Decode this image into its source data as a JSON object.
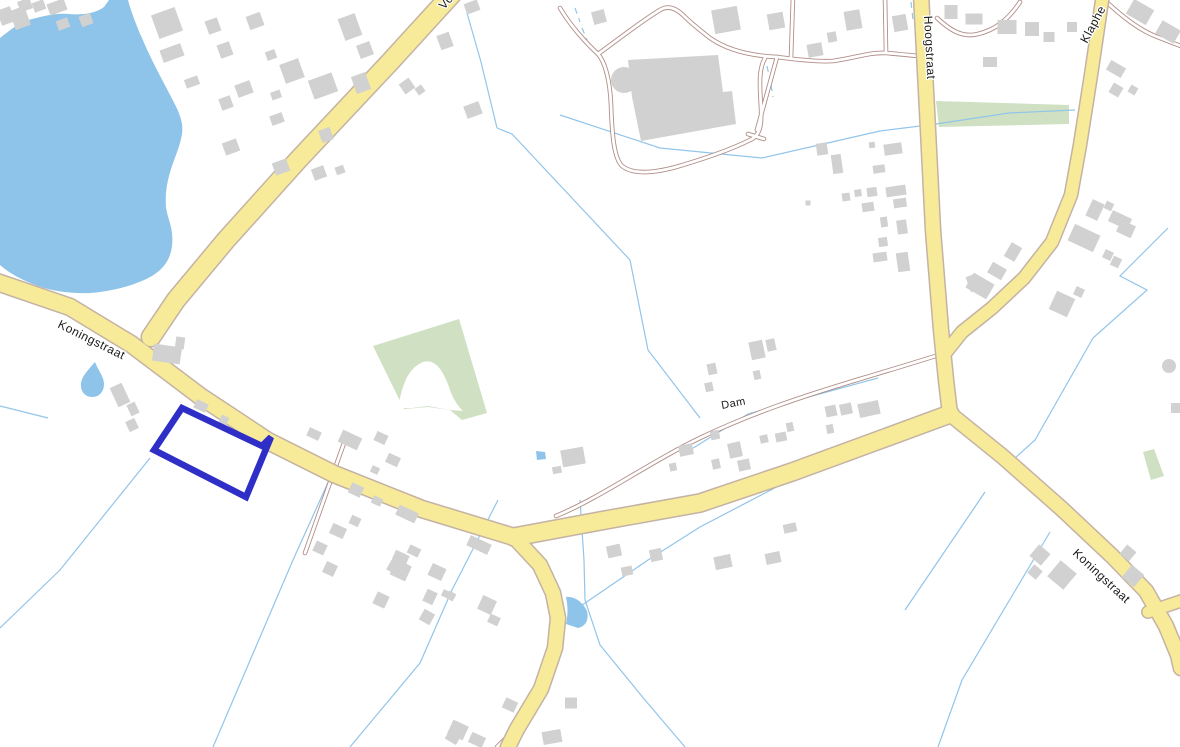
{
  "map": {
    "title": "Topographic cadastral map with selected parcel",
    "colors": {
      "background": "#ffffff",
      "water": "#8ec4e9",
      "green": "#cfe0c3",
      "boundary_line": "#92c5ea",
      "road_fill": "#f7ea99",
      "road_casing": "#c4b3a4",
      "minor_casing": "#b18e88",
      "minor_fill": "#ffffff",
      "building": "#d1d1d1",
      "parcel_highlight": "#2f2fc7",
      "label_text": "#1a1a1a"
    },
    "labels": [
      {
        "text": "Vo",
        "x": 444,
        "y": 10,
        "rotate": -48,
        "size": 12
      },
      {
        "text": "Koningstraat",
        "x": 57,
        "y": 327,
        "rotate": 26.5,
        "size": 12
      },
      {
        "text": "Hoogstraat",
        "x": 924,
        "y": 16,
        "rotate": 87,
        "size": 12
      },
      {
        "text": "Klaphe",
        "x": 1087,
        "y": 44,
        "rotate": -62,
        "size": 12
      },
      {
        "text": "Dam",
        "x": 722,
        "y": 409,
        "rotate": -11,
        "size": 11
      },
      {
        "text": "Koningstraat",
        "x": 1072,
        "y": 554,
        "rotate": 43,
        "size": 12
      }
    ],
    "water": {
      "lake": "M 0,38 C 10,30 20,22 32,19 C 45,16 55,13 68,14 C 80,15 95,14 104,7 L 109,0 L 128,0 C 130,8 136,25 142,38 C 150,57 158,72 167,89 C 174,103 180,112 182,124 C 184,136 177,152 172,166 C 167,181 165,193 166,207 C 168,221 174,228 172,246 C 170,261 163,269 152,276 C 138,284 120,289 100,292 C 80,295 55,292 38,286 C 24,281 10,274 0,265 Z",
      "ponds": [
        "M 95,362 C 99,372 104,377 104,384 C 104,392 99,397 92,397 C 85,397 80,391 81,383 C 82,376 88,370 95,362 Z",
        "M 566,597 C 574,596 583,602 587,611 C 589,620 586,626 578,628 L 566,624 C 568,615 568,606 566,597 Z",
        "M 536,451 l 9,1 1,7 -9,1 Z"
      ]
    },
    "green_areas": [
      "M 936,101 L 1069,105 L 1069,124 L 939,127 Z",
      "M 373,346 L 459,319 L 487,413 L 462,420 L 450,410 L 428,407 L 404,409 Z",
      "M 1143,452 L 1154,449 L 1164,476 L 1151,480 Z"
    ],
    "green_cutouts": [
      "M 398,408 C 402,385 408,368 423,362 C 436,358 444,372 450,390 C 453,399 458,406 463,411 L 450,410 L 428,406 L 412,408 Z"
    ],
    "boundary_lines": [
      {
        "points": "467,13 481,62 497,128"
      },
      {
        "points": "497,128 512,134 630,260"
      },
      {
        "points": "630,260 648,350 700,418"
      },
      {
        "points": "560,115 660,148 762,158 880,131 936,124"
      },
      {
        "points": "936,124 1009,113 1075,110"
      },
      {
        "points": "690,450 748,414 812,396 878,378"
      },
      {
        "points": "498,500 452,590 420,663 350,747"
      },
      {
        "points": "580,500 584,560 585,600 600,645 645,700 685,747"
      },
      {
        "points": "572,612 648,560 700,527 790,480"
      },
      {
        "points": "345,445 293,560 213,747"
      },
      {
        "points": "150,458 60,570 0,628"
      },
      {
        "points": "0,406 48,418"
      },
      {
        "points": "1093,338 1035,440 1004,468"
      },
      {
        "points": "1168,228 1120,276 1147,290 1093,338"
      },
      {
        "points": "985,492 905,610"
      },
      {
        "points": "1050,532 962,680 938,747"
      },
      {
        "points": "767,66 770,80",
        "dash": true
      },
      {
        "points": "771,85 773,97",
        "dash": true
      },
      {
        "points": "911,2 913,20",
        "dash": true
      },
      {
        "points": "575,8 580,22",
        "dash": true
      },
      {
        "points": "582,28 587,40",
        "dash": true
      }
    ],
    "major_roads": [
      {
        "d": "M 452,-6 L 390,62 L 298,160 L 226,240 L 176,300 L 151,337",
        "w": 18
      },
      {
        "d": "M -6,281 L 70,307 L 131,344 L 200,396 L 268,441 L 334,474 L 422,509 L 514,537",
        "w": 16
      },
      {
        "d": "M 514,537 L 540,565 L 553,593 L 558,618 L 555,648 L 541,689 L 517,729 L 508,747",
        "w": 14
      },
      {
        "d": "M 514,537 L 600,521 L 700,503 L 792,472 L 882,439 L 950,414",
        "w": 17
      },
      {
        "d": "M 921,-6 L 927,110 L 933,230 L 941,330 L 946,380 L 950,414",
        "w": 14
      },
      {
        "d": "M 950,414 L 1002,456 L 1062,509 L 1112,556 L 1146,591 L 1166,626 L 1178,655 L 1181,668",
        "w": 14
      },
      {
        "d": "M 1148,612 L 1181,601",
        "w": 11
      },
      {
        "d": "M 1103,-6 L 1091,75 L 1080,145 L 1071,195 L 1052,242 L 1024,278 L 992,308 L 962,332 L 946,352",
        "w": 12
      }
    ],
    "minor_roads": [
      {
        "d": "M 556,516 C 600,498 650,462 700,438 C 750,414 800,397 860,379 C 900,367 930,358 948,352"
      },
      {
        "d": "M 560,8 C 570,25 585,42 598,54 C 605,62 610,80 611,105 C 612,135 614,158 622,166 C 632,174 650,174 676,167 C 700,160 730,150 750,140 C 760,136 762,125 761,108 C 760,88 758,70 765,58"
      },
      {
        "d": "M 598,54 C 615,42 640,22 660,10 C 668,5 676,8 684,16 C 692,24 700,30 710,38 C 730,52 755,56 777,57"
      },
      {
        "d": "M 777,57 C 800,60 820,62 833,61 C 855,58 870,52 886,53 C 898,54 908,55 918,56"
      },
      {
        "d": "M 793,-4 L 791,58"
      },
      {
        "d": "M 885,-4 L 886,52"
      },
      {
        "d": "M 777,57 L 757,130"
      },
      {
        "d": "M 748,134 L 764,139"
      },
      {
        "d": "M 937,18 C 950,30 962,38 978,34 C 995,30 1008,20 1020,2"
      },
      {
        "d": "M 1100,-4 C 1115,10 1135,28 1155,36 C 1165,40 1175,44 1181,46"
      },
      {
        "d": "M 344,443 L 305,553"
      },
      {
        "d": "M 497,747 L 515,729"
      }
    ],
    "big_building": {
      "body": "M 628,60 L 718,55 L 723,92 L 732,91 L 736,124 L 641,141 L 632,97 Z",
      "tower": {
        "cx": 624,
        "cy": 80,
        "r": 13
      }
    },
    "round_building": {
      "cx": 1169,
      "cy": 366,
      "r": 7
    },
    "buildings": [
      [
        6,
        16,
        14,
        16,
        -20
      ],
      [
        20,
        18,
        16,
        20,
        -20
      ],
      [
        25,
        5,
        13,
        11,
        -20
      ],
      [
        39,
        6,
        12,
        10,
        -20
      ],
      [
        57,
        7,
        18,
        12,
        -20
      ],
      [
        63,
        24,
        12,
        10,
        -20
      ],
      [
        86,
        20,
        12,
        11,
        -20
      ],
      [
        167,
        23,
        25,
        25,
        -20
      ],
      [
        172,
        53,
        22,
        13,
        -20
      ],
      [
        213,
        26,
        13,
        14,
        -20
      ],
      [
        225,
        50,
        13,
        14,
        -20
      ],
      [
        255,
        21,
        15,
        14,
        -20
      ],
      [
        271,
        55,
        10,
        9,
        -20
      ],
      [
        192,
        82,
        14,
        9,
        -20
      ],
      [
        226,
        103,
        12,
        12,
        -20
      ],
      [
        244,
        89,
        16,
        13,
        -20
      ],
      [
        292,
        71,
        20,
        20,
        -20
      ],
      [
        323,
        86,
        25,
        20,
        -20
      ],
      [
        276,
        95,
        10,
        8,
        -20
      ],
      [
        277,
        119,
        13,
        10,
        -20
      ],
      [
        326,
        135,
        12,
        13,
        -20
      ],
      [
        350,
        27,
        18,
        23,
        -20
      ],
      [
        365,
        50,
        14,
        14,
        -20
      ],
      [
        361,
        83,
        15,
        18,
        -20
      ],
      [
        231,
        147,
        15,
        13,
        -20
      ],
      [
        281,
        167,
        15,
        13,
        -20
      ],
      [
        319,
        173,
        13,
        12,
        -20
      ],
      [
        340,
        170,
        9,
        8,
        -20
      ],
      [
        407,
        86,
        12,
        12,
        -35
      ],
      [
        420,
        90,
        8,
        8,
        -35
      ],
      [
        445,
        41,
        13,
        15,
        -20
      ],
      [
        472,
        7,
        14,
        11,
        -20
      ],
      [
        473,
        110,
        16,
        13,
        -20
      ],
      [
        599,
        17,
        13,
        13,
        -15
      ],
      [
        726,
        20,
        26,
        24,
        -10
      ],
      [
        776,
        21,
        16,
        16,
        -10
      ],
      [
        815,
        50,
        15,
        13,
        -10
      ],
      [
        832,
        37,
        9,
        10,
        -10
      ],
      [
        853,
        20,
        16,
        19,
        -10
      ],
      [
        900,
        23,
        14,
        16,
        -10
      ],
      [
        951,
        12,
        13,
        14,
        0
      ],
      [
        974,
        19,
        17,
        11,
        0
      ],
      [
        1007,
        27,
        19,
        14,
        0
      ],
      [
        1032,
        29,
        14,
        14,
        0
      ],
      [
        1049,
        37,
        11,
        10,
        0
      ],
      [
        1072,
        27,
        10,
        10,
        0
      ],
      [
        990,
        62,
        14,
        10,
        0
      ],
      [
        822,
        149,
        11,
        12,
        -8
      ],
      [
        837,
        164,
        10,
        19,
        -8
      ],
      [
        872,
        145,
        6,
        6,
        -8
      ],
      [
        893,
        149,
        18,
        11,
        -8
      ],
      [
        879,
        169,
        12,
        8,
        -8
      ],
      [
        846,
        197,
        8,
        8,
        -8
      ],
      [
        858,
        193,
        7,
        7,
        -8
      ],
      [
        872,
        192,
        10,
        9,
        -8
      ],
      [
        896,
        191,
        20,
        10,
        -8
      ],
      [
        900,
        203,
        13,
        9,
        -8
      ],
      [
        868,
        207,
        12,
        9,
        -8
      ],
      [
        884,
        222,
        7,
        10,
        -8
      ],
      [
        902,
        227,
        10,
        14,
        -8
      ],
      [
        883,
        242,
        9,
        9,
        -8
      ],
      [
        880,
        257,
        14,
        9,
        -8
      ],
      [
        903,
        262,
        12,
        19,
        -8
      ],
      [
        808,
        203,
        5,
        5,
        0
      ],
      [
        973,
        283,
        10,
        16,
        -20
      ],
      [
        757,
        350,
        14,
        18,
        -12
      ],
      [
        771,
        345,
        9,
        12,
        -12
      ],
      [
        712,
        369,
        9,
        11,
        -12
      ],
      [
        757,
        375,
        7,
        9,
        -12
      ],
      [
        709,
        387,
        8,
        9,
        -12
      ],
      [
        831,
        411,
        11,
        11,
        -12
      ],
      [
        846,
        409,
        12,
        11,
        -12
      ],
      [
        869,
        409,
        21,
        14,
        -12
      ],
      [
        830,
        429,
        7,
        9,
        -12
      ],
      [
        781,
        437,
        11,
        9,
        -12
      ],
      [
        764,
        439,
        8,
        8,
        -12
      ],
      [
        735,
        450,
        13,
        15,
        -12
      ],
      [
        715,
        435,
        9,
        9,
        -12
      ],
      [
        790,
        427,
        7,
        9,
        -12
      ],
      [
        686,
        450,
        14,
        11,
        -12
      ],
      [
        673,
        467,
        7,
        8,
        -12
      ],
      [
        716,
        464,
        8,
        10,
        -12
      ],
      [
        744,
        465,
        12,
        11,
        -12
      ],
      [
        167,
        354,
        28,
        17,
        8
      ],
      [
        180,
        343,
        9,
        12,
        8
      ],
      [
        120,
        395,
        13,
        21,
        -25
      ],
      [
        133,
        409,
        9,
        12,
        -25
      ],
      [
        132,
        425,
        10,
        11,
        -25
      ],
      [
        201,
        406,
        13,
        9,
        25
      ],
      [
        224,
        420,
        8,
        8,
        25
      ],
      [
        314,
        434,
        13,
        9,
        25
      ],
      [
        350,
        440,
        21,
        13,
        25
      ],
      [
        381,
        438,
        12,
        10,
        25
      ],
      [
        393,
        460,
        13,
        10,
        25
      ],
      [
        375,
        470,
        8,
        7,
        25
      ],
      [
        356,
        490,
        13,
        11,
        25
      ],
      [
        377,
        501,
        10,
        8,
        25
      ],
      [
        407,
        514,
        21,
        11,
        25
      ],
      [
        338,
        531,
        15,
        11,
        25
      ],
      [
        355,
        521,
        10,
        9,
        25
      ],
      [
        320,
        548,
        12,
        11,
        25
      ],
      [
        401,
        557,
        15,
        9,
        25
      ],
      [
        400,
        572,
        17,
        13,
        25
      ],
      [
        414,
        551,
        12,
        9,
        25
      ],
      [
        437,
        572,
        15,
        13,
        25
      ],
      [
        430,
        597,
        11,
        13,
        25
      ],
      [
        446,
        594,
        8,
        7,
        25
      ],
      [
        381,
        600,
        13,
        13,
        25
      ],
      [
        479,
        545,
        23,
        11,
        25
      ],
      [
        487,
        605,
        15,
        15,
        25
      ],
      [
        494,
        620,
        11,
        9,
        25
      ],
      [
        330,
        569,
        12,
        12,
        25
      ],
      [
        458,
        730,
        17,
        15,
        25
      ],
      [
        477,
        740,
        15,
        11,
        25
      ],
      [
        510,
        705,
        13,
        11,
        25
      ],
      [
        552,
        737,
        19,
        13,
        -10
      ],
      [
        571,
        703,
        12,
        11,
        0
      ],
      [
        399,
        568,
        21,
        15,
        30
      ],
      [
        427,
        617,
        12,
        12,
        30
      ],
      [
        451,
        596,
        8,
        8,
        30
      ],
      [
        573,
        457,
        23,
        17,
        -10
      ],
      [
        557,
        470,
        9,
        7,
        -10
      ],
      [
        614,
        551,
        14,
        12,
        -12
      ],
      [
        627,
        571,
        11,
        9,
        -12
      ],
      [
        656,
        555,
        12,
        12,
        -12
      ],
      [
        723,
        562,
        17,
        13,
        -12
      ],
      [
        773,
        558,
        15,
        11,
        -12
      ],
      [
        790,
        528,
        13,
        9,
        -12
      ],
      [
        980,
        286,
        24,
        17,
        30
      ],
      [
        997,
        271,
        16,
        12,
        30
      ],
      [
        1013,
        252,
        12,
        16,
        30
      ],
      [
        1095,
        210,
        13,
        18,
        25
      ],
      [
        1109,
        206,
        8,
        8,
        25
      ],
      [
        1120,
        220,
        21,
        12,
        25
      ],
      [
        1126,
        229,
        16,
        13,
        25
      ],
      [
        1084,
        238,
        28,
        18,
        25
      ],
      [
        1108,
        255,
        9,
        9,
        25
      ],
      [
        1116,
        262,
        9,
        10,
        25
      ],
      [
        1062,
        304,
        20,
        20,
        25
      ],
      [
        1079,
        292,
        9,
        9,
        25
      ],
      [
        1140,
        12,
        23,
        17,
        30
      ],
      [
        1168,
        32,
        21,
        15,
        30
      ],
      [
        1116,
        69,
        17,
        11,
        30
      ],
      [
        1116,
        90,
        11,
        11,
        30
      ],
      [
        1133,
        90,
        8,
        8,
        30
      ],
      [
        1040,
        555,
        15,
        15,
        40
      ],
      [
        1035,
        572,
        11,
        11,
        40
      ],
      [
        1062,
        575,
        21,
        21,
        40
      ],
      [
        1128,
        553,
        12,
        12,
        40
      ],
      [
        1133,
        576,
        16,
        16,
        40
      ],
      [
        1176,
        408,
        10,
        10,
        0
      ],
      [
        453,
        737,
        13,
        11,
        30
      ]
    ],
    "selected_parcel": {
      "points": "182,408 262,446 271,437 246,497 154,450",
      "stroke_width": 6.5
    }
  }
}
